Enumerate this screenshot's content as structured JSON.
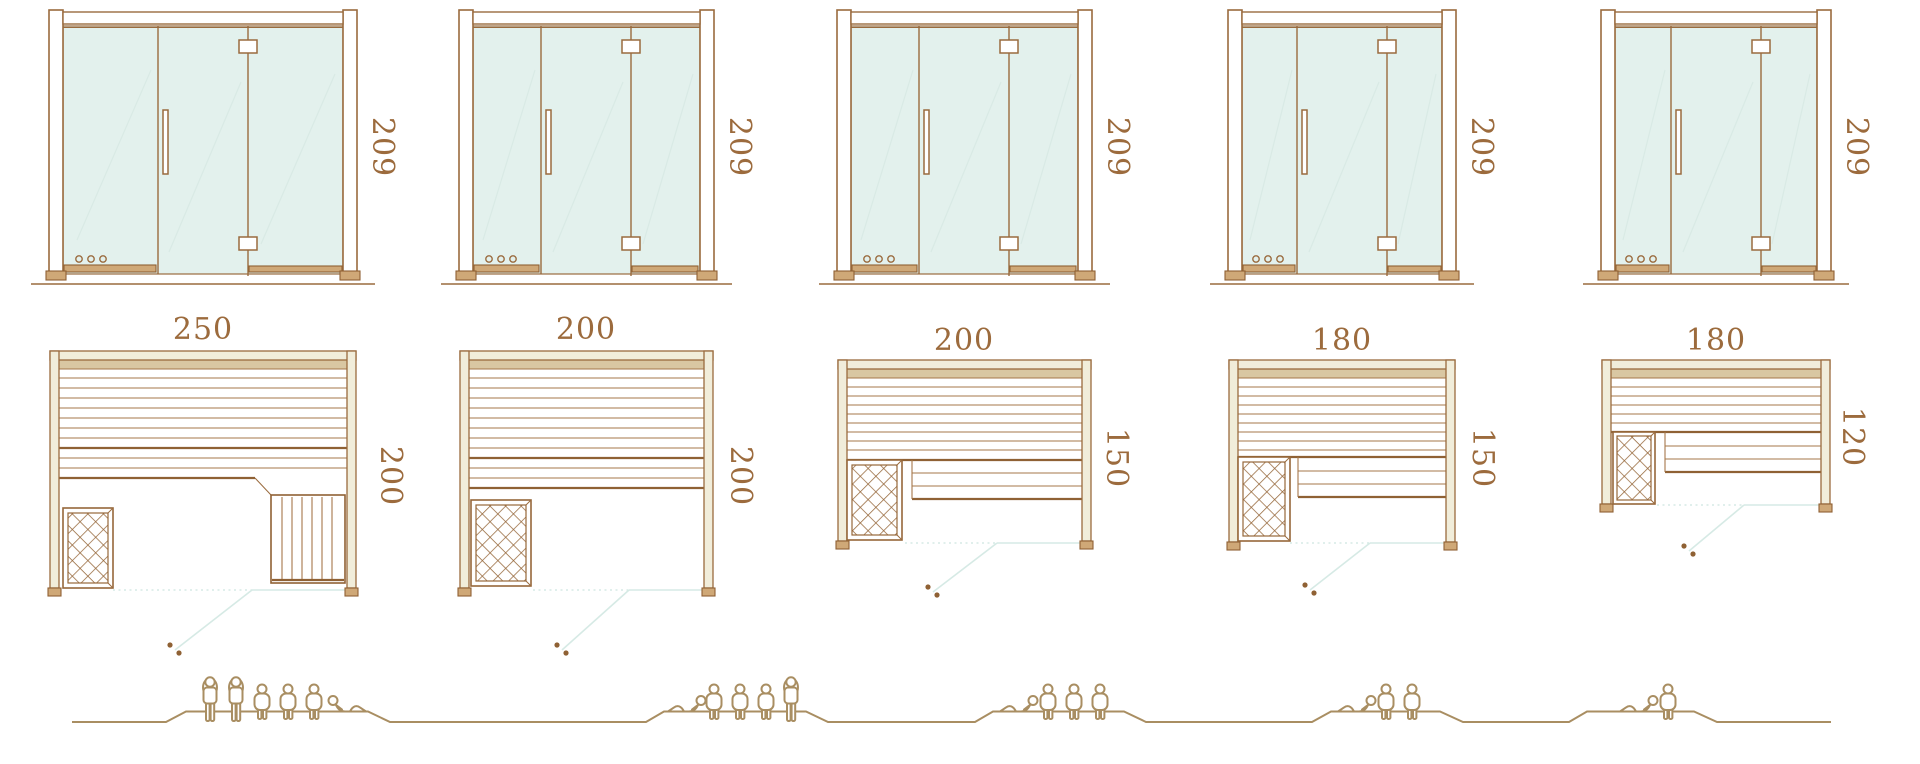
{
  "diagram_title": "sauna-size-comparison",
  "palette": {
    "line_brown": "#9a6b3e",
    "dark_brown": "#8f6134",
    "text_brown": "#9c6b3d",
    "glass_fill": "#e3f1ed",
    "glass_reflection": "#d9eae5",
    "wall_fill": "#f1edda",
    "backrest_fill": "#d9c7a2",
    "sill_fill": "#cfa877",
    "door_swing": "#d6eae5",
    "people_tan": "#a98e62"
  },
  "units": [
    {
      "name": "sauna-250x200",
      "elevation_height": "209",
      "plan_width": "250",
      "plan_depth": "200",
      "capacity": {
        "standing": 2,
        "sitting": 3,
        "lying": 1,
        "total": 6
      }
    },
    {
      "name": "sauna-200x200",
      "elevation_height": "209",
      "plan_width": "200",
      "plan_depth": "200",
      "capacity": {
        "standing": 1,
        "sitting": 3,
        "lying": 1,
        "total": 5
      }
    },
    {
      "name": "sauna-200x150",
      "elevation_height": "209",
      "plan_width": "200",
      "plan_depth": "150",
      "capacity": {
        "standing": 0,
        "sitting": 3,
        "lying": 1,
        "total": 4
      }
    },
    {
      "name": "sauna-180x150",
      "elevation_height": "209",
      "plan_width": "180",
      "plan_depth": "150",
      "capacity": {
        "standing": 0,
        "sitting": 2,
        "lying": 1,
        "total": 3
      }
    },
    {
      "name": "sauna-180x120",
      "elevation_height": "209",
      "plan_width": "180",
      "plan_depth": "120",
      "capacity": {
        "standing": 0,
        "sitting": 1,
        "lying": 1,
        "total": 2
      }
    }
  ]
}
